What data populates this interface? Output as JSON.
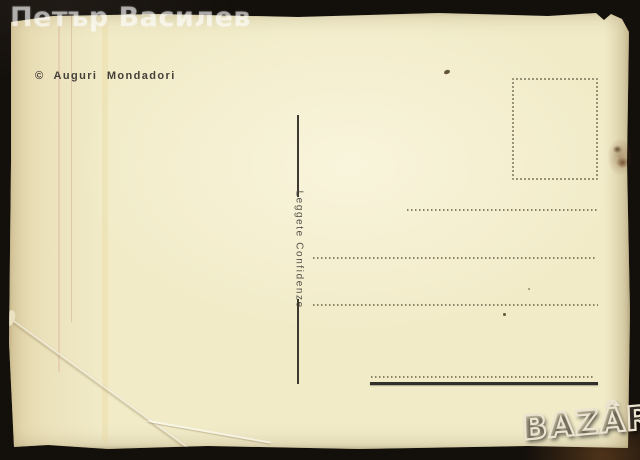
{
  "watermark": {
    "text": "Петър Василев",
    "color": "rgba(255,255,255,0.55)"
  },
  "postcard": {
    "publisher_credit": "© Auguri Mondadori",
    "divider_label": "Leggete Confidenze",
    "paper_color": "#f1ebc8",
    "ink_color": "#45403a",
    "dotted_line_color": "#8b8166",
    "thick_line_color": "#31302a"
  },
  "logo": {
    "text": "BAZÂR",
    "outline_color": "#ece4d0"
  },
  "background_color": "#130f0b"
}
